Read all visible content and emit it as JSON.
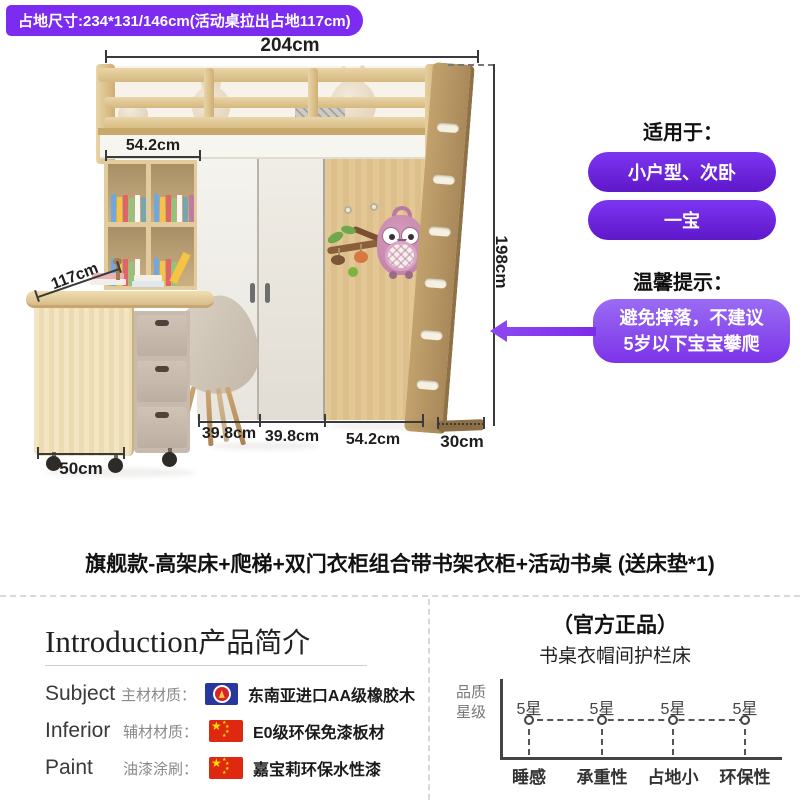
{
  "hero": {
    "badge": "占地尺寸:234*131/146cm(活动桌拉出占地117cm)",
    "dims": {
      "top_width": "204cm",
      "shelf_width": "54.2cm",
      "desk_depth": "117cm",
      "height": "198cm",
      "door_left": "39.8cm",
      "door_right": "39.8cm",
      "panel_width": "54.2cm",
      "ladder_depth": "30cm",
      "cabinet_width": "50cm"
    },
    "suit_title": "适用于：",
    "pills": [
      {
        "label": "小户型、次卧"
      },
      {
        "label": "一宝"
      }
    ],
    "tip_title": "温馨提示：",
    "tip_line1": "避免摔落，不建议",
    "tip_line2": "5岁以下宝宝攀爬"
  },
  "product_title": "旗舰款-高架床+爬梯+双门衣柜组合带书架衣柜+活动书桌 (送床垫*1)",
  "intro": {
    "heading_en": "Introduction",
    "heading_zh": "产品简介",
    "rows": [
      {
        "en": "Subject",
        "zh": "主材材质：",
        "flag": "asean-flag",
        "value": "东南亚进口AA级橡胶木"
      },
      {
        "en": "Inferior",
        "zh": "辅材材质：",
        "flag": "china-flag",
        "value": "E0级环保免漆板材"
      },
      {
        "en": "Paint",
        "zh": "油漆涂刷：",
        "flag": "china-flag",
        "value": "嘉宝莉环保水性漆"
      }
    ]
  },
  "quality": {
    "official_badge": "（官方正品）",
    "subtitle": "书桌衣帽间护栏床",
    "ylabel_line1": "品质",
    "ylabel_line2": "星级",
    "points": [
      {
        "star": "5星",
        "label": "睡感"
      },
      {
        "star": "5星",
        "label": "承重性"
      },
      {
        "star": "5星",
        "label": "占地小"
      },
      {
        "star": "5星",
        "label": "环保性"
      }
    ]
  },
  "chart_data": {
    "type": "scatter",
    "title": "书桌衣帽间护栏床",
    "ylabel": "品质星级",
    "categories": [
      "睡感",
      "承重性",
      "占地小",
      "环保性"
    ],
    "values": [
      "5星",
      "5星",
      "5星",
      "5星"
    ],
    "legend": "none",
    "note": "flat dashed line, every category rated 5 stars"
  },
  "colors": {
    "accent_purple": "#7C2BF0",
    "pill_purple": "#6A24DD",
    "tip_purple": "#8B4DF0",
    "flag_china_red": "#DE2910",
    "flag_asean_blue": "#27379B",
    "wood": "#DFC493"
  }
}
